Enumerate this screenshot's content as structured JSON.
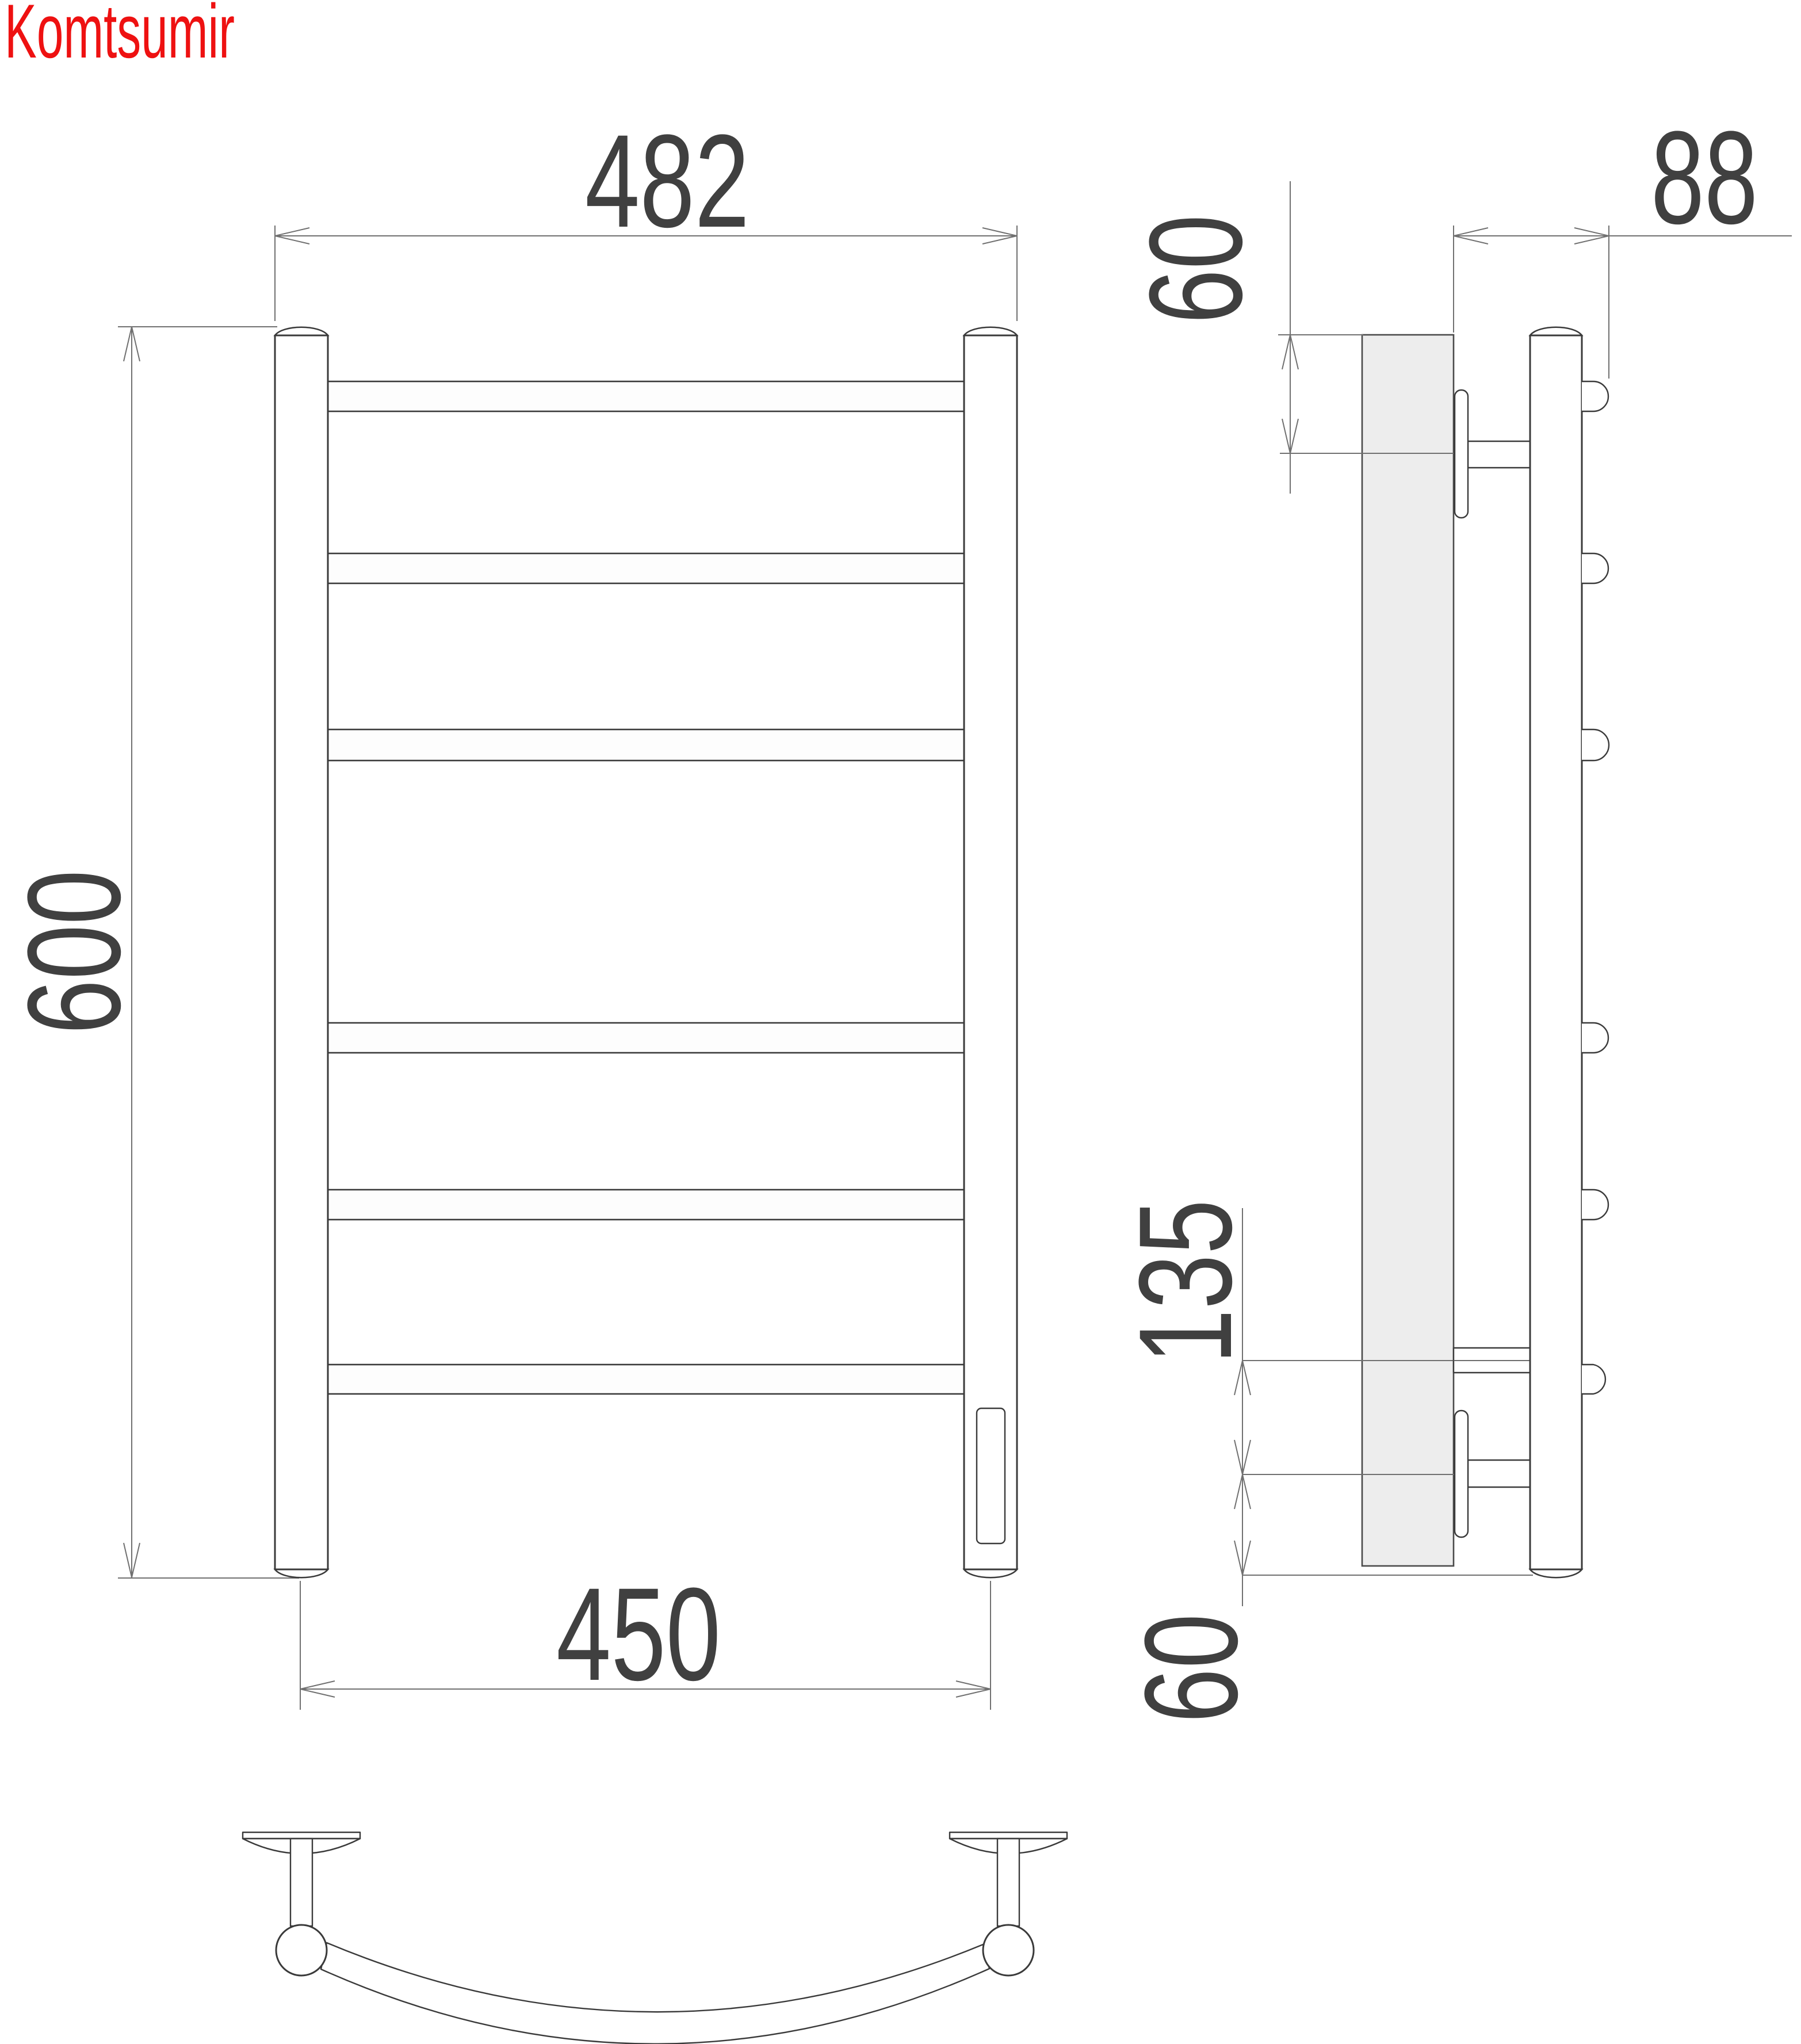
{
  "brand": {
    "label": "Komtsumir",
    "color": "#ee1111"
  },
  "labels": {
    "width_top": "482",
    "height": "600",
    "width_bottom": "450",
    "depth": "88",
    "offset_top": "60",
    "span_mid": "135",
    "offset_bottom": "60"
  },
  "views": {
    "front": {
      "rung_count": 6,
      "has_element_window": true
    },
    "side": {
      "rung_end_count": 6,
      "bracket_count": 2,
      "has_wall_plate": true
    },
    "plan": {
      "mount_count": 2,
      "rail_curved": true
    }
  },
  "colors": {
    "line": "#3a3a3a",
    "dim_line": "#707070",
    "text": "#404040",
    "wall_plate_fill": "#ededed",
    "background": "#ffffff"
  }
}
